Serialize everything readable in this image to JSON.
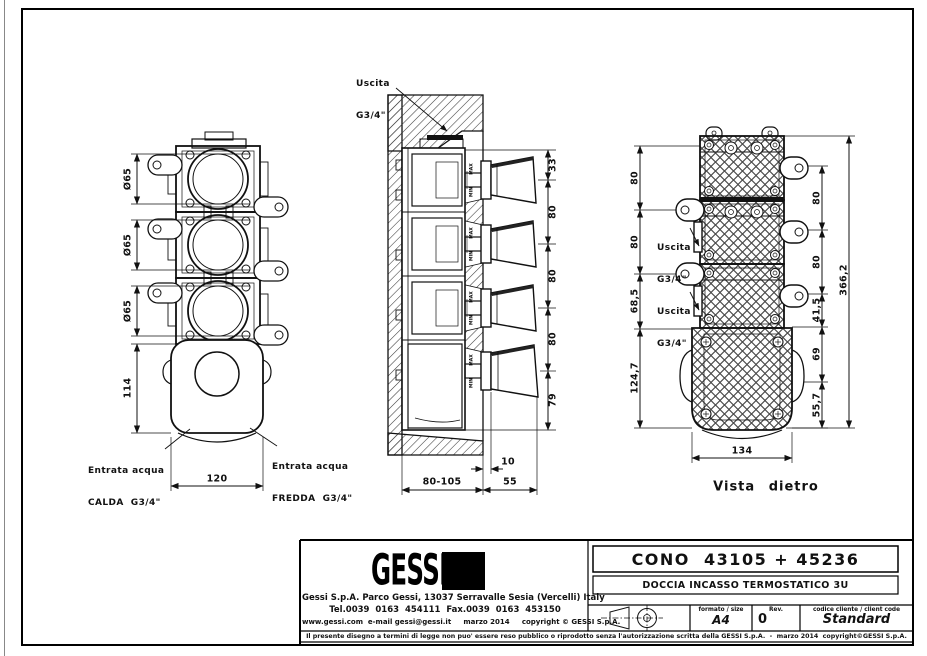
{
  "colors": {
    "line": "#111111",
    "paper": "#ffffff"
  },
  "front_view": {
    "dim_d65_1": "Ø65",
    "dim_d65_2": "Ø65",
    "dim_d65_3": "Ø65",
    "dim_114": "114",
    "dim_120": "120",
    "inlet_hot_1": "Entrata acqua",
    "inlet_hot_2": "CALDA  G3/4\"",
    "inlet_cold_1": "Entrata acqua",
    "inlet_cold_2": "FREDDA  G3/4\""
  },
  "section_view": {
    "outlet_1": "Uscita",
    "outlet_2": "G3/4\"",
    "dim_33": "33",
    "dim_80a": "80",
    "dim_80b": "80",
    "dim_80c": "80",
    "dim_79": "79",
    "dim_10": "10",
    "dim_depth": "80-105",
    "dim_55": "55",
    "min": "MIN",
    "max": "MAX"
  },
  "rear_view": {
    "caption": "Vista dietro",
    "outlet_1": "Uscita",
    "outlet_2": "G3/4\"",
    "dim_l80a": "80",
    "dim_l80b": "80",
    "dim_l685": "68,5",
    "dim_l1247": "124,7",
    "dim_r80a": "80",
    "dim_r80b": "80",
    "dim_r415": "41,5",
    "dim_r69": "69",
    "dim_r557": "55,7",
    "dim_total": "366,2",
    "dim_134": "134"
  },
  "title_block": {
    "logo_text": "GESSI",
    "company_line1": "Gessi S.p.A. Parco Gessi, 13037 Serravalle Sesia (Vercelli) Italy",
    "company_line2": "Tel.0039  0163  454111  Fax.0039  0163  453150",
    "company_line3": "www.gessi.com  e-mail gessi@gessi.it     marzo 2014     copyright © GESSI S.p.A.",
    "product_code": "CONO  43105 + 45236",
    "product_description": "DOCCIA INCASSO TERMOSTATICO 3U",
    "format_label": "formato / size",
    "format_value": "A4",
    "rev_label": "Rev.",
    "rev_value": "0",
    "client_code_label": "codice cliente / client code",
    "client_code_value": "Standard",
    "disclaimer": "Il presente disegno a termini di legge non puo' essere reso pubblico o riprodotto senza l'autorizzazione scritta della GESSI S.p.A.  -  marzo 2014  copyright©GESSI S.p.A."
  }
}
